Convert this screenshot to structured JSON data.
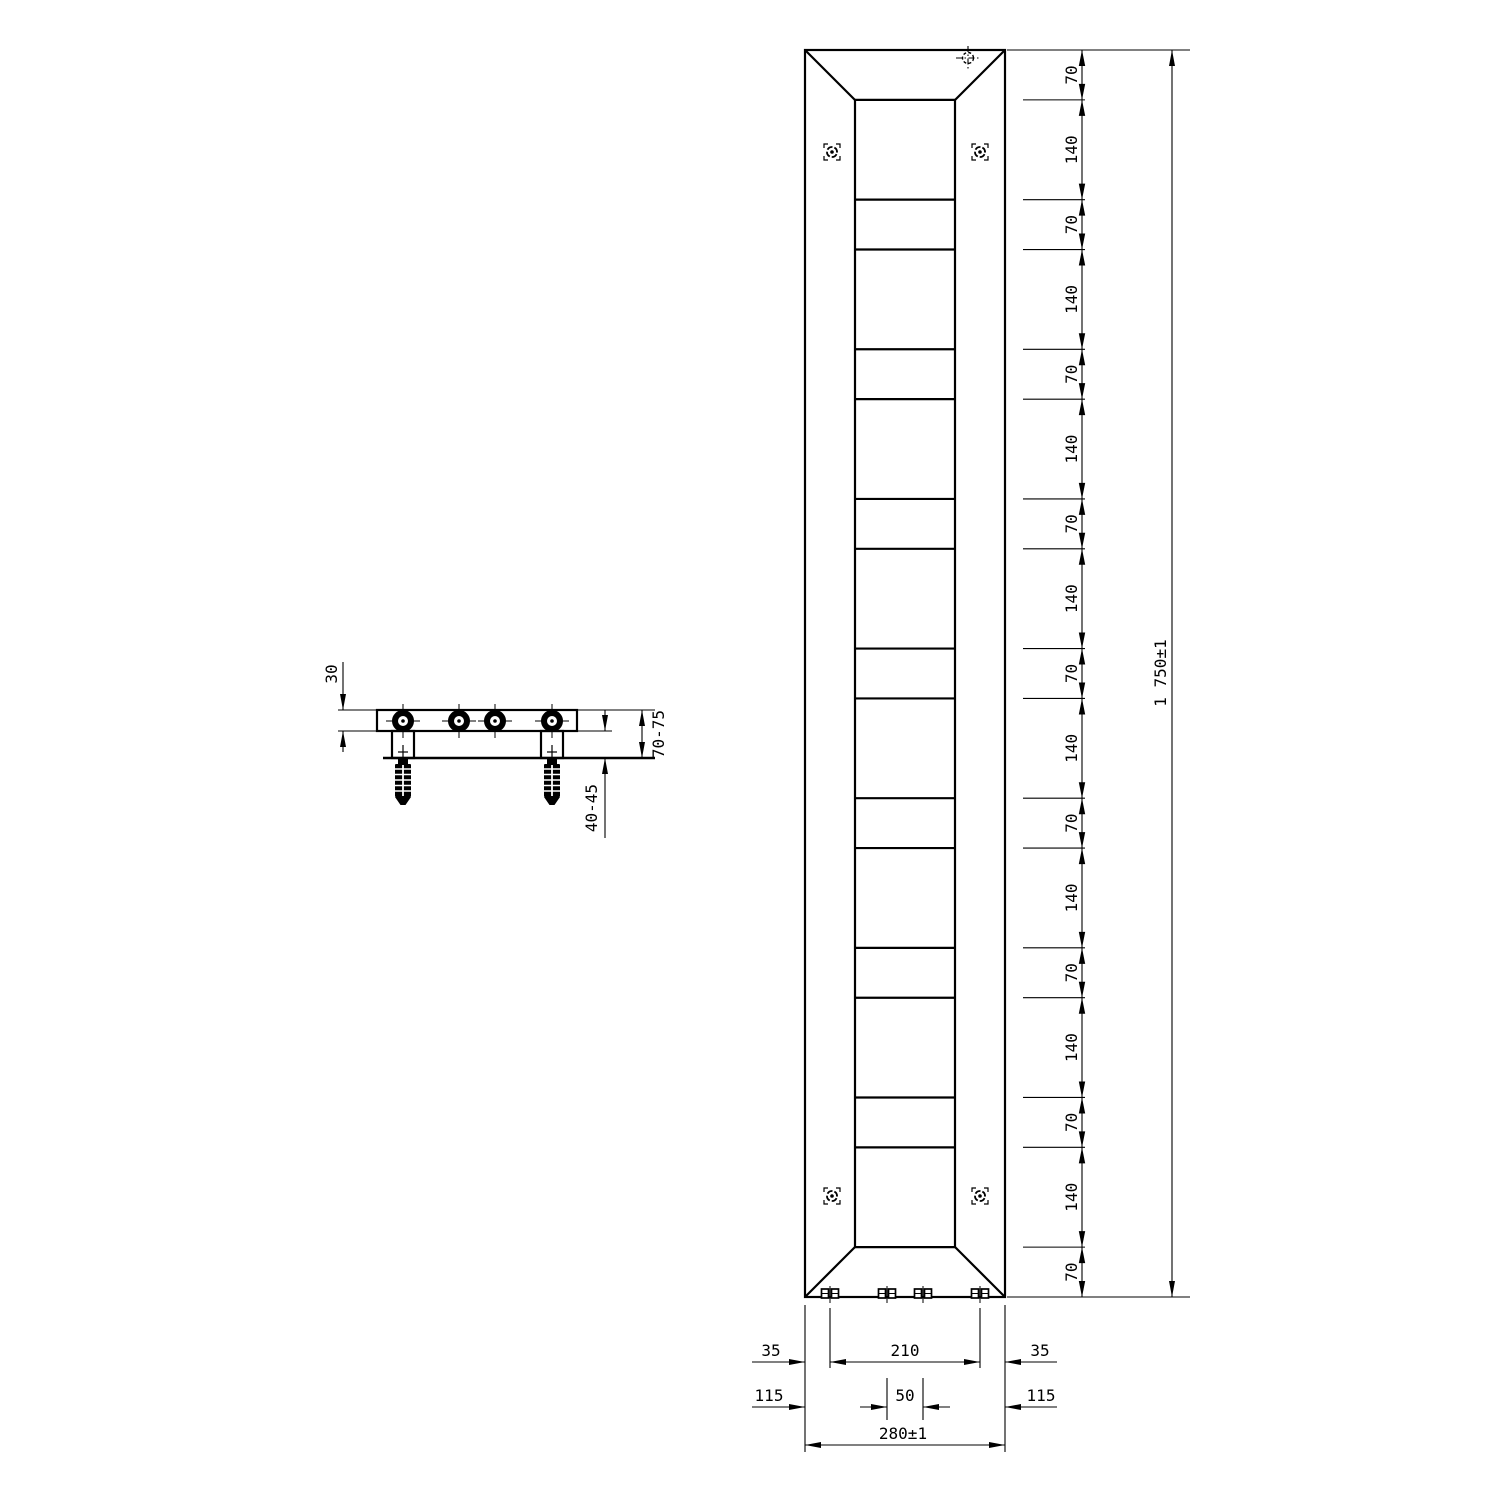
{
  "drawing_type": "radiator technical drawing",
  "colors": {
    "background": "#ffffff",
    "line": "#000000"
  },
  "side_view": {
    "depth": "30",
    "wall_clearance": "70-75",
    "anchor_depth": "40-45"
  },
  "front_view": {
    "overall_height": "1 750±1",
    "chain_segments": [
      "70",
      "140",
      "70",
      "140",
      "70",
      "140",
      "70",
      "140",
      "70",
      "140",
      "70",
      "140",
      "70",
      "140",
      "70",
      "140",
      "70"
    ],
    "bottom": {
      "left_offset": "35",
      "connection_span": "210",
      "right_offset": "35",
      "left_margin": "115",
      "center_pair_span": "50",
      "right_margin": "115",
      "overall_width": "280±1"
    }
  }
}
